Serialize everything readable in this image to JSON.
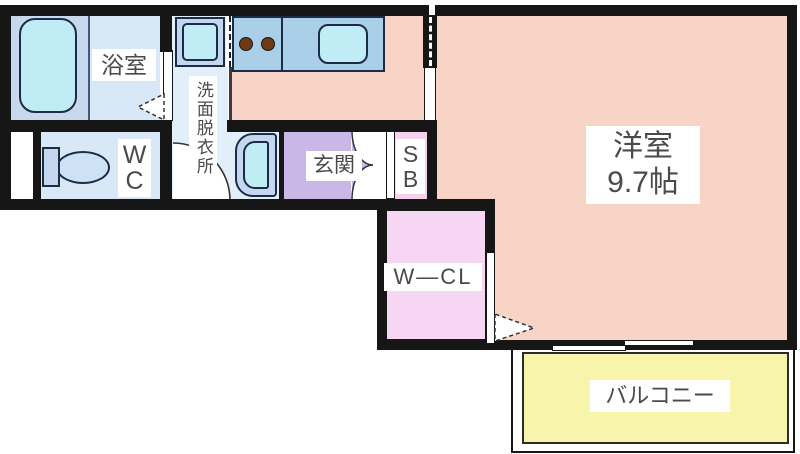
{
  "colors": {
    "wall": "#161616",
    "outline": "#1e2b47",
    "text": "#4a4a4a",
    "label_bg": "#ffffff",
    "room_pink": "#f8d4c6",
    "bath_floor": "#d9e8f7",
    "tub_zone": "#c7d8ef",
    "washroom_floor": "#e3eefb",
    "fixture_cyan": "#c0edf5",
    "fixture_blue": "#c3d8f0",
    "counter_blue": "#a9cfe9",
    "entrance_purple": "#c9b7e7",
    "sb_pink": "#f6d0ed",
    "wcl_pink": "#f7d6f4",
    "balcony_yellow": "#f8f4ac",
    "burner_brown": "#6e3a13"
  },
  "rooms": {
    "bathroom": {
      "label": "浴室"
    },
    "washroom": {
      "label": "洗面脱衣所"
    },
    "wc": {
      "line1": "W",
      "line2": "C"
    },
    "entrance": {
      "label": "玄関"
    },
    "shoe_box": {
      "line1": "S",
      "line2": "B"
    },
    "western_room": {
      "name": "洋室",
      "size": "9.7帖"
    },
    "walk_in_closet": {
      "label": "W—CL"
    },
    "balcony": {
      "label": "バルコニー"
    }
  }
}
